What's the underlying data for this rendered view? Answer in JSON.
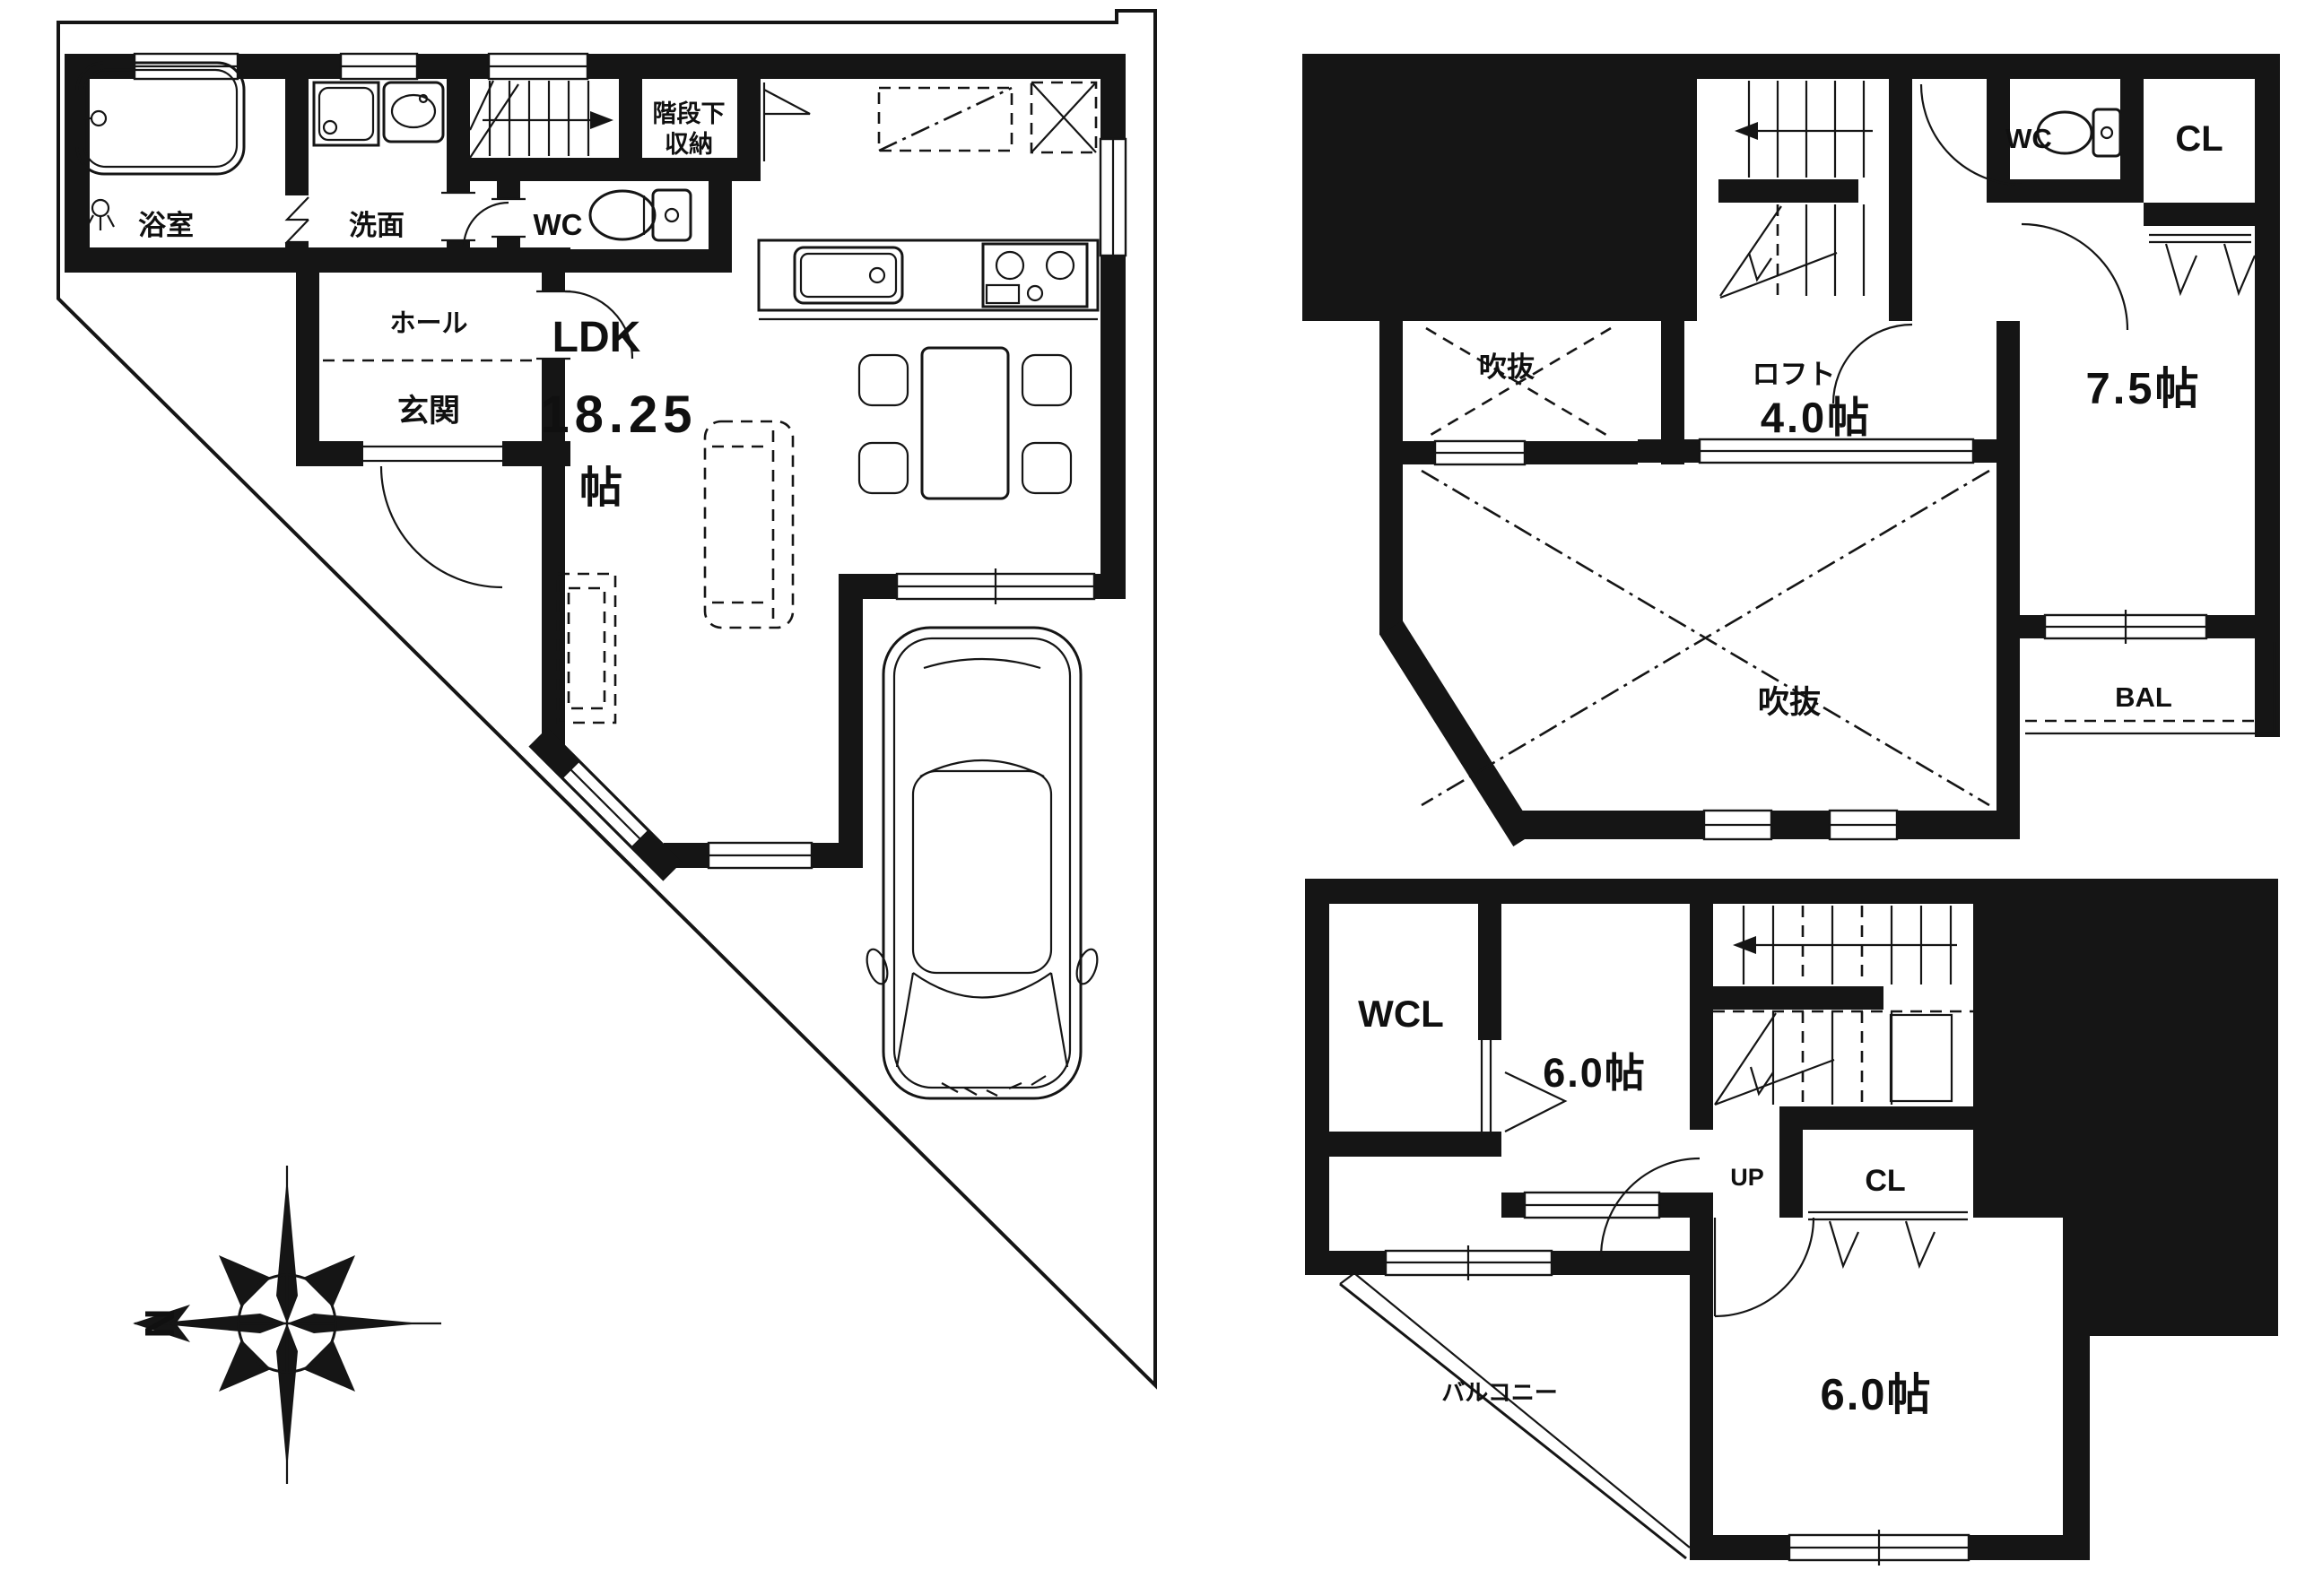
{
  "colors": {
    "ink": "#151515",
    "paper": "#ffffff"
  },
  "f1": {
    "bath": "浴室",
    "wash": "洗面",
    "wc": "WC",
    "hall": "ホール",
    "entrance": "玄関",
    "ldk": "LDK",
    "ldk_size": "18.25",
    "ldk_unit": "帖",
    "storage1": "階段下",
    "storage2": "収納",
    "north": "N"
  },
  "f3": {
    "void_top": "吹抜",
    "loft": "ロフト",
    "loft_size": "4.0帖",
    "room": "7.5帖",
    "wc": "WC",
    "cl": "CL",
    "void_bottom": "吹抜",
    "bal": "BAL"
  },
  "f2": {
    "wcl": "WCL",
    "room_n": "6.0帖",
    "up": "UP",
    "cl": "CL",
    "balcony": "バルコニー",
    "room_s": "6.0帖"
  }
}
